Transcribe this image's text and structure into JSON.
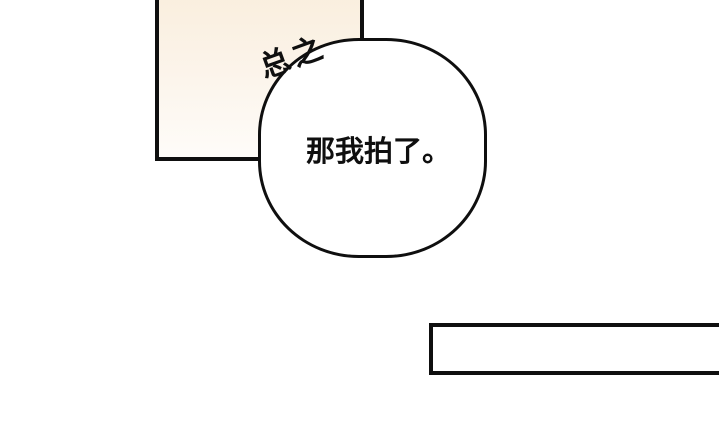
{
  "page": {
    "type": "comic-panel-page"
  },
  "colors": {
    "bg": "#ffffff",
    "ink": "#0f0f0f",
    "panel_top": "#f9eedd",
    "panel_mid": "#fcf5ec",
    "panel_bottom": "#fefcf9",
    "bubble_fill": "#ffffff"
  },
  "speech_bubble": {
    "text": "那我拍了。"
  },
  "caption": {
    "text": "总之"
  }
}
